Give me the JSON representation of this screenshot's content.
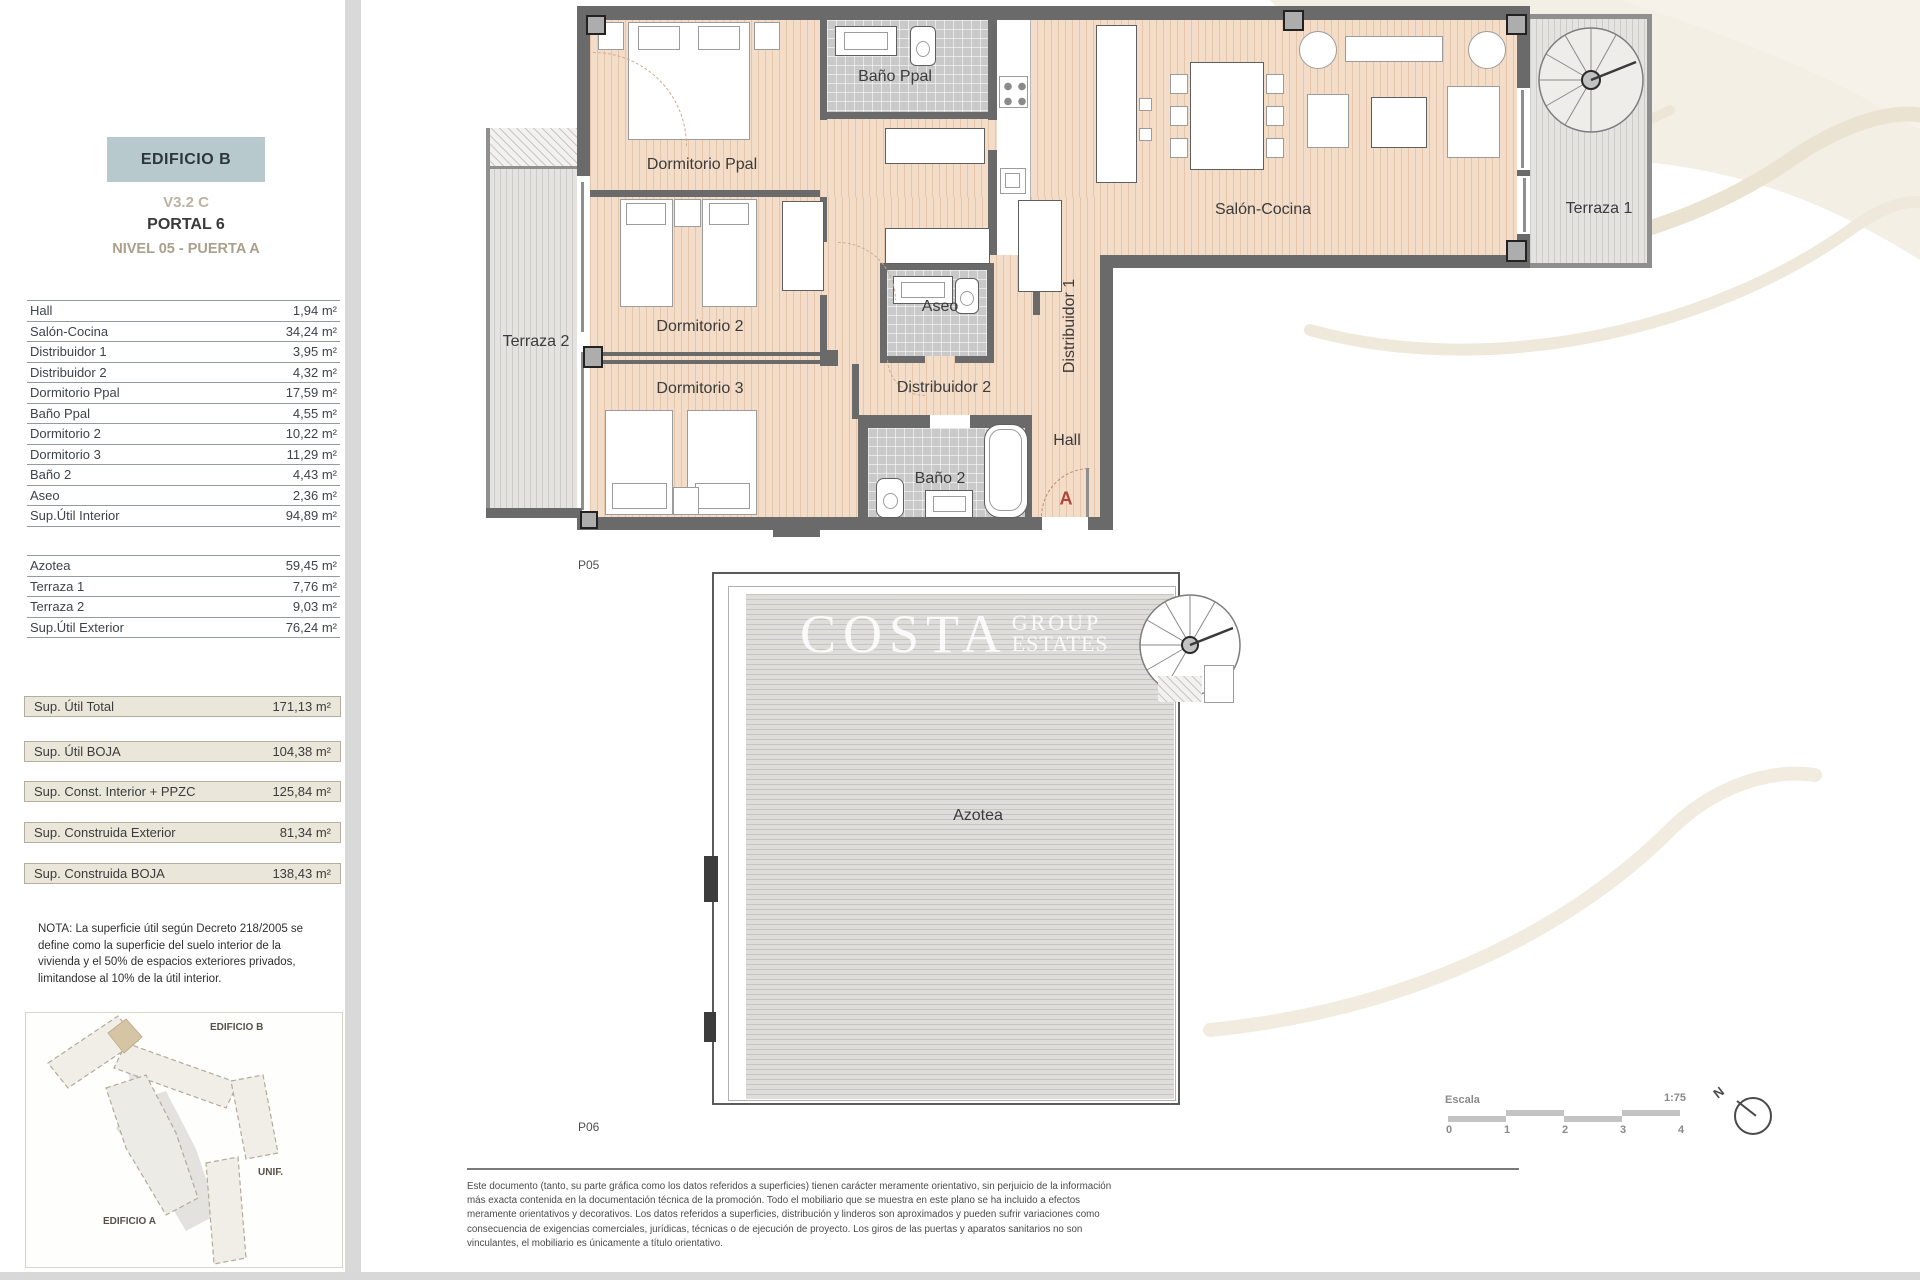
{
  "header": {
    "building": "EDIFICIO B",
    "version": "V3.2 C",
    "portal": "PORTAL 6",
    "level": "NIVEL 05 - PUERTA A"
  },
  "interior_table": {
    "rows": [
      {
        "label": "Hall",
        "value": "1,94 m²"
      },
      {
        "label": "Salón-Cocina",
        "value": "34,24 m²"
      },
      {
        "label": "Distribuidor 1",
        "value": "3,95 m²"
      },
      {
        "label": "Distribuidor 2",
        "value": "4,32 m²"
      },
      {
        "label": "Dormitorio Ppal",
        "value": "17,59 m²"
      },
      {
        "label": "Baño Ppal",
        "value": "4,55 m²"
      },
      {
        "label": "Dormitorio 2",
        "value": "10,22 m²"
      },
      {
        "label": "Dormitorio 3",
        "value": "11,29 m²"
      },
      {
        "label": "Baño 2",
        "value": "4,43 m²"
      },
      {
        "label": "Aseo",
        "value": "2,36 m²"
      },
      {
        "label": "Sup.Útil Interior",
        "value": "94,89 m²"
      }
    ]
  },
  "exterior_table": {
    "rows": [
      {
        "label": "Azotea",
        "value": "59,45 m²"
      },
      {
        "label": "Terraza 1",
        "value": "7,76 m²"
      },
      {
        "label": "Terraza 2",
        "value": "9,03 m²"
      },
      {
        "label": "Sup.Útil Exterior",
        "value": "76,24 m²"
      }
    ]
  },
  "summary_boxes": [
    {
      "label": "Sup. Útil Total",
      "value": "171,13 m²"
    },
    {
      "label": "Sup. Útil BOJA",
      "value": "104,38 m²"
    },
    {
      "label": "Sup. Const. Interior + PPZC",
      "value": "125,84 m²"
    },
    {
      "label": "Sup. Construida Exterior",
      "value": "81,34 m²"
    },
    {
      "label": "Sup. Construida BOJA",
      "value": "138,43 m²"
    }
  ],
  "note_lines": [
    "NOTA: La superficie útil según Decreto 218/2005 se",
    "define como la superficie del suelo interior de la",
    "vivienda y el 50% de espacios exteriores privados,",
    "limitandose al 10% de la útil interior."
  ],
  "sitemap": {
    "label_b": "EDIFICIO B",
    "label_unif": "UNIF.",
    "label_a": "EDIFICIO A"
  },
  "plan": {
    "page_upper": "P05",
    "page_lower": "P06",
    "rooms": {
      "bano_ppal": "Baño Ppal",
      "dormitorio_ppal": "Dormitorio Ppal",
      "salon_cocina": "Salón-Cocina",
      "terraza_1": "Terraza 1",
      "terraza_2": "Terraza 2",
      "dormitorio_2": "Dormitorio 2",
      "aseo": "Aseo",
      "distribuidor_1": "Distribuidor 1",
      "dormitorio_3": "Dormitorio 3",
      "distribuidor_2": "Distribuidor 2",
      "hall": "Hall",
      "bano_2": "Baño 2",
      "azotea": "Azotea"
    },
    "entry_letter": "A"
  },
  "watermark": {
    "brand": "COSTA",
    "line1": "GROUP",
    "line2": "ESTATES"
  },
  "scale": {
    "label": "Escala",
    "ratio": "1:75",
    "ticks": [
      "0",
      "1",
      "2",
      "3",
      "4"
    ],
    "north_letter": "N"
  },
  "disclaimer_lines": [
    "Este documento (tanto, su parte gráfica como los datos referidos a superficies) tienen carácter meramente orientativo, sin perjuicio de la información",
    "más exacta contenida en la documentación técnica de la promoción. Todo el mobiliario que se muestra en este plano se ha incluido a efectos",
    "meramente orientativos y decorativos. Los datos referidos a superficies, distribución y linderos son aproximados y pueden sufrir variaciones como",
    "consecuencia de exigencias comerciales, jurídicas, técnicas o de ejecución de proyecto. Los giros de las puertas y aparatos sanitarios no son",
    "vinculantes, el mobiliario es únicamente a título orientativo."
  ],
  "colors": {
    "header_box": "#b7c9cc",
    "highlight_unit": "#d6c5a4",
    "entry_letter": "#b0453a",
    "wood_floor": "#f3ddc8",
    "terrace_floor": "#e4e3e0",
    "tile_floor": "#c9c9c9",
    "wall": "#6a6a6a",
    "summary_box_bg": "#eae6d9"
  }
}
